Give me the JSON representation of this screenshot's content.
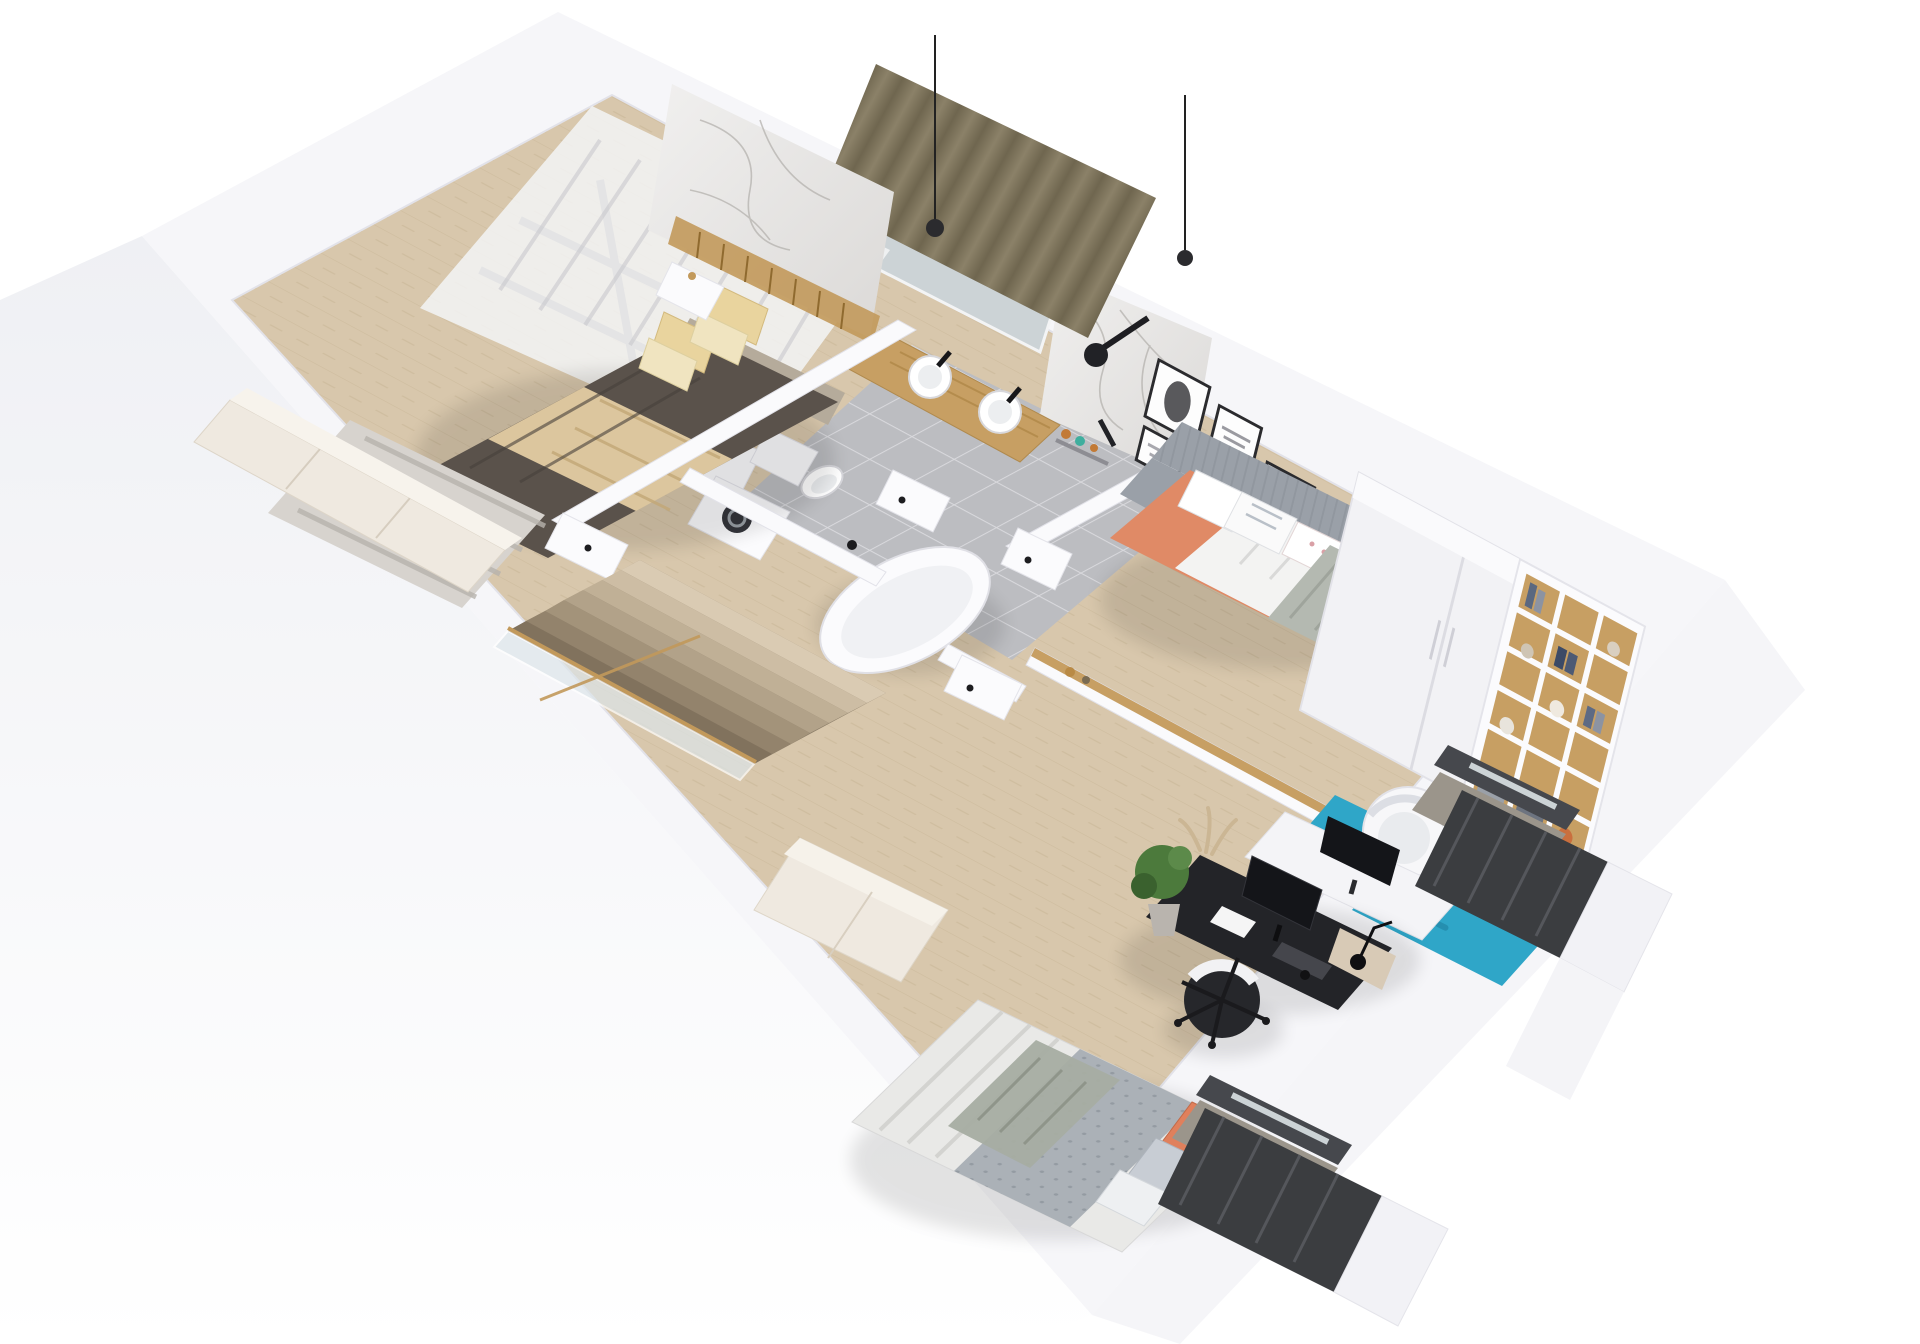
{
  "scene": {
    "title": "3D isometric cut-away floor plan render - upper floor apartment",
    "style": "photoreal architectural dollhouse view, white shell on white background"
  },
  "palette": {
    "bg": "#ffffff",
    "outer-wall": "#f6f6f9",
    "wall-face": "#fafafc",
    "wall-edge": "#e2e2e9",
    "face-bl": "#eff0f4",
    "face-r": "#f2f2f6",
    "floor-wood": "#d8c7ac",
    "floor-wood-line": "#c7b493",
    "tile": "#bcbdc1",
    "tile-grout": "#d9d9dd",
    "marble-a": "#f1f0ef",
    "marble-b": "#dbd9d7",
    "marble-vein": "#b4b1ae",
    "brass": "#c2995b",
    "curtain-olive": "#8b8168",
    "curtain-olive-dk": "#6f664f",
    "curtain-sheer": "#f3f4f6",
    "window-dark": "#7a7a7e",
    "headboard": "#b5ab9b",
    "duvet-dark": "#5a524b",
    "throw-beige": "#dcc69e",
    "pillow-yellow": "#e9d49e",
    "pillow-cream": "#f0e4c0",
    "rug-master": "#d7d3ce",
    "rug-master-line": "#b7b3ad",
    "daybed-grey": "#9aa0a8",
    "daybed-orange": "#e08a66",
    "blanket-knit": "#b4b9b1",
    "teal": "#2fa6c8",
    "teal-dk": "#1d7e9e",
    "oak": "#c79f63",
    "wardrobe": "#f2f2f5",
    "desk-black": "#232428",
    "monitor": "#141519",
    "chair-dark": "#26272b",
    "quilt": "#abb1b7",
    "quilt-dot": "#8e959d",
    "pillow-orange": "#e0805c",
    "cabinet-cream": "#efe9e0",
    "rail-dark": "#3b3d40",
    "glass": "#ccd3d6",
    "plant": "#4c7a3c",
    "plant-dk": "#3a612e",
    "pot": "#b9b4ae",
    "white-fur": "#fbfbfd"
  },
  "rooms": [
    {
      "id": "master-bedroom",
      "label": "Master bedroom",
      "furniture": [
        "double bed with dark duvet and beige throw",
        "grey upholstered headboard",
        "four yellow and cream pillows",
        "white nightstand",
        "two black pendant lights",
        "marble feature wall with brass slats",
        "olive curtain",
        "sheer curtain",
        "striped grey rug",
        "cream sideboard"
      ]
    },
    {
      "id": "bathroom",
      "label": "Bathroom",
      "furniture": [
        "oak double vanity with two round vessel sinks",
        "black faucets",
        "wall mirror",
        "black rain shower on marble wall",
        "shelf with amber and teal bottles",
        "freestanding bathtub",
        "wall-hung toilet",
        "washing machine",
        "grey floor tiles"
      ]
    },
    {
      "id": "hallway",
      "label": "Hallway landing",
      "furniture": [
        "stair void with descending steps",
        "glass balustrade",
        "brass handrail",
        "white doors with black handles"
      ]
    },
    {
      "id": "kids-room",
      "label": "Kids bedroom",
      "furniture": [
        "grey channel-tufted daybed",
        "orange bed sheet",
        "white and floral pillows",
        "grey knit blanket",
        "gallery wall with six framed prints (leaf, typography, pink abstract, deer line art)",
        "white two-door wardrobe",
        "oak cubby bookshelf with books and toys",
        "teal shaggy rug",
        "white tub chair",
        "white desk with dark monitor",
        "potted plant"
      ]
    },
    {
      "id": "teen-room",
      "label": "Teen bedroom / study",
      "furniture": [
        "black desk with monitor, keyboard, papers and desk lamp",
        "black and white office chair",
        "fiddle-leaf fig in basket pot",
        "pampas grass",
        "single bed with ribbed white foot section, grey quilt, orange and grey pillows",
        "cream low cabinet"
      ]
    },
    {
      "id": "balconies",
      "label": "Juliet balconies",
      "furniture": [
        "dark metal railing at kids room",
        "dark metal railing at teen room",
        "white parapet piers",
        "dark glazed door frames"
      ]
    }
  ]
}
